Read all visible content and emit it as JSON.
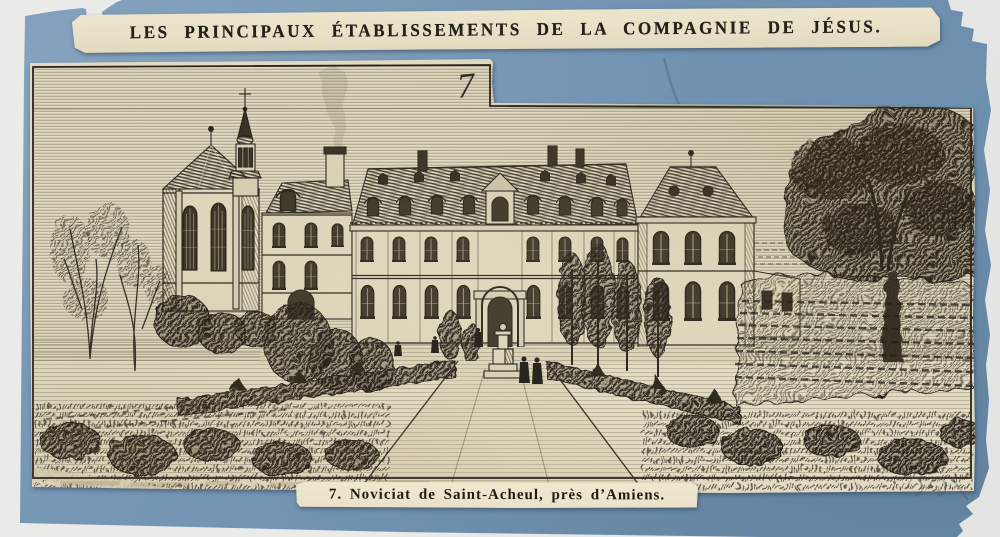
{
  "document": {
    "header": {
      "title": "LES PRINCIPAUX ÉTABLISSEMENTS DE LA COMPAGNIE DE JÉSUS."
    },
    "plate": {
      "number": "7"
    },
    "caption": {
      "text": "7. Noviciat de Saint-Acheul, près d’Amiens."
    },
    "colors": {
      "card_blue": "#7293b1",
      "paper_cream": "#e6dfc6",
      "ink": "#26221b",
      "scan_background": "#e9e9e7"
    }
  }
}
